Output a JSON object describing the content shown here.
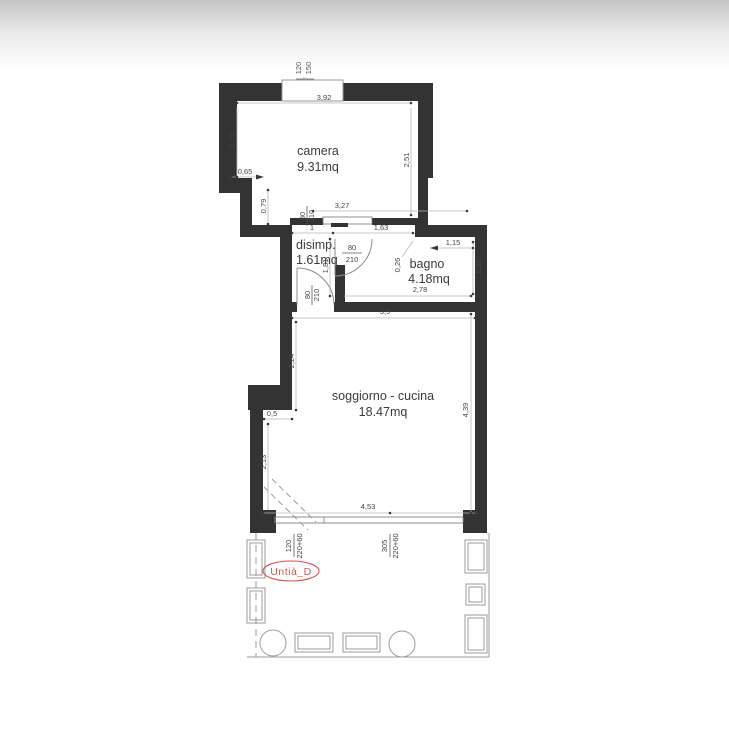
{
  "plan": {
    "rooms": {
      "camera": {
        "name": "camera",
        "area": "9.31mq"
      },
      "disimpegno": {
        "name": "disimp.",
        "area": "1.61mq"
      },
      "bagno": {
        "name": "bagno",
        "area": "4.18mq"
      },
      "soggiorno": {
        "name": "soggiorno - cucina",
        "area": "18.47mq"
      }
    },
    "dims": {
      "top_window_width": "120",
      "top_window_height": "150",
      "camera_top": "3,92",
      "camera_left": "1,72",
      "camera_right": "2,51",
      "wall_step_h": "0,65",
      "wall_step_v": "0,79",
      "camera_door_w": "80",
      "camera_door_h": "210",
      "camera_bottom_wall": "3,27",
      "disimp_top": "1",
      "opening_width": "1,63",
      "bagno_door_w": "80",
      "bagno_door_h": "210",
      "disimp_height": "1,81",
      "wall_stub": "0,26",
      "bagno_top": "1,15",
      "bagno_right": "1,35",
      "bagno_bottom": "2,78",
      "disimp_door_w": "80",
      "disimp_door_h": "210",
      "soggiorno_top": "3,9",
      "soggiorno_left_upper": "2,24",
      "soggiorno_right": "4,39",
      "wall_recess": "0,5",
      "soggiorno_left_lower": "2,13",
      "soggiorno_bottom": "4,53",
      "window1_width": "120",
      "window1_height": "220+60",
      "window2_width": "305",
      "window2_height": "220+60"
    },
    "stamp": {
      "label": "Untià_D"
    },
    "colors": {
      "wall": "#333333",
      "dim_text": "#474747",
      "stamp_red": "#d9534f"
    }
  }
}
